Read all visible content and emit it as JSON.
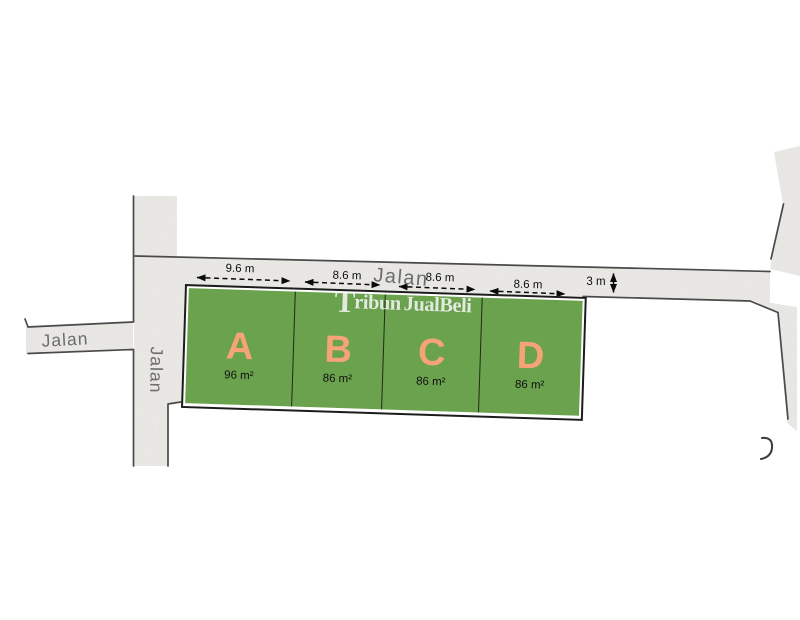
{
  "roads": {
    "top_label": "Jalan",
    "left_label": "Jalan",
    "vertical_label": "Jalan"
  },
  "dimensions": {
    "plot_a_width": "9.6 m",
    "plot_b_width": "8.6 m",
    "plot_c_width": "8.6 m",
    "plot_d_width": "8.6 m",
    "road_width": "3 m"
  },
  "plots": [
    {
      "label": "A",
      "area": "96 m²"
    },
    {
      "label": "B",
      "area": "86 m²"
    },
    {
      "label": "C",
      "area": "86 m²"
    },
    {
      "label": "D",
      "area": "86 m²"
    }
  ],
  "watermark": {
    "initial": "T",
    "part1": "ribun",
    "part2": "JualBeli"
  },
  "colors": {
    "plot_green": "#6aa24d",
    "plot_label_orange": "#f5a377",
    "road_fill": "#ecebe8",
    "block_outline": "#1c1c1c",
    "road_edge": "#4a4a4a",
    "road_label_gray": "#6d6d6d"
  }
}
